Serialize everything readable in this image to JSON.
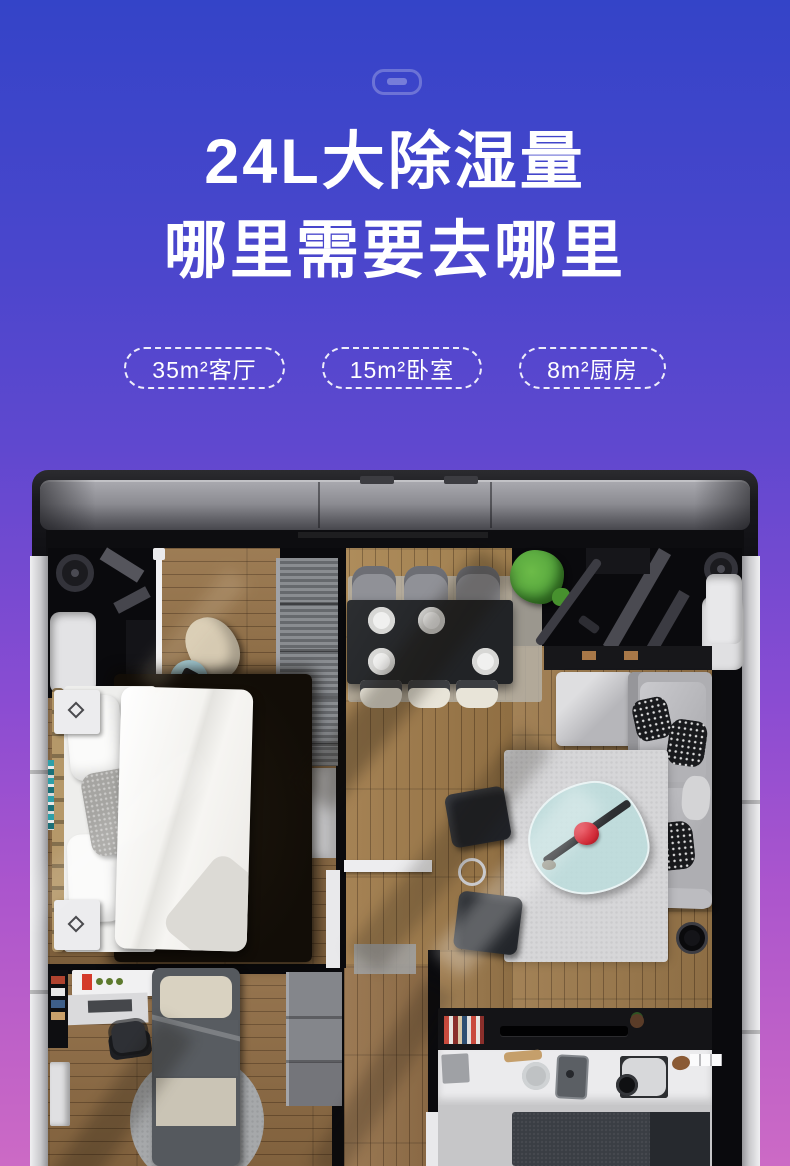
{
  "page": {
    "background_gradient_top": "#3444c8",
    "background_gradient_middle": "#8a4cd2",
    "background_gradient_bottom": "#cc6ac5",
    "text_color": "#ffffff"
  },
  "header": {
    "handle_icon": "drawer-handle-icon",
    "title_line1": "24L大除湿量",
    "title_line2": "哪里需要去哪里",
    "badges": [
      "35m²客厅",
      "15m²卧室",
      "8m²厨房"
    ]
  },
  "floorplan": {
    "style": "3d-top-view-apartment-inside-dehumidifier-frame",
    "accent_flower_color": "#cf2633",
    "plant_color": "#57a73e",
    "machine_band_color": "#8c8c92",
    "wall_color": "#0a0a0d",
    "outer_wall_color": "#d9d9db"
  }
}
